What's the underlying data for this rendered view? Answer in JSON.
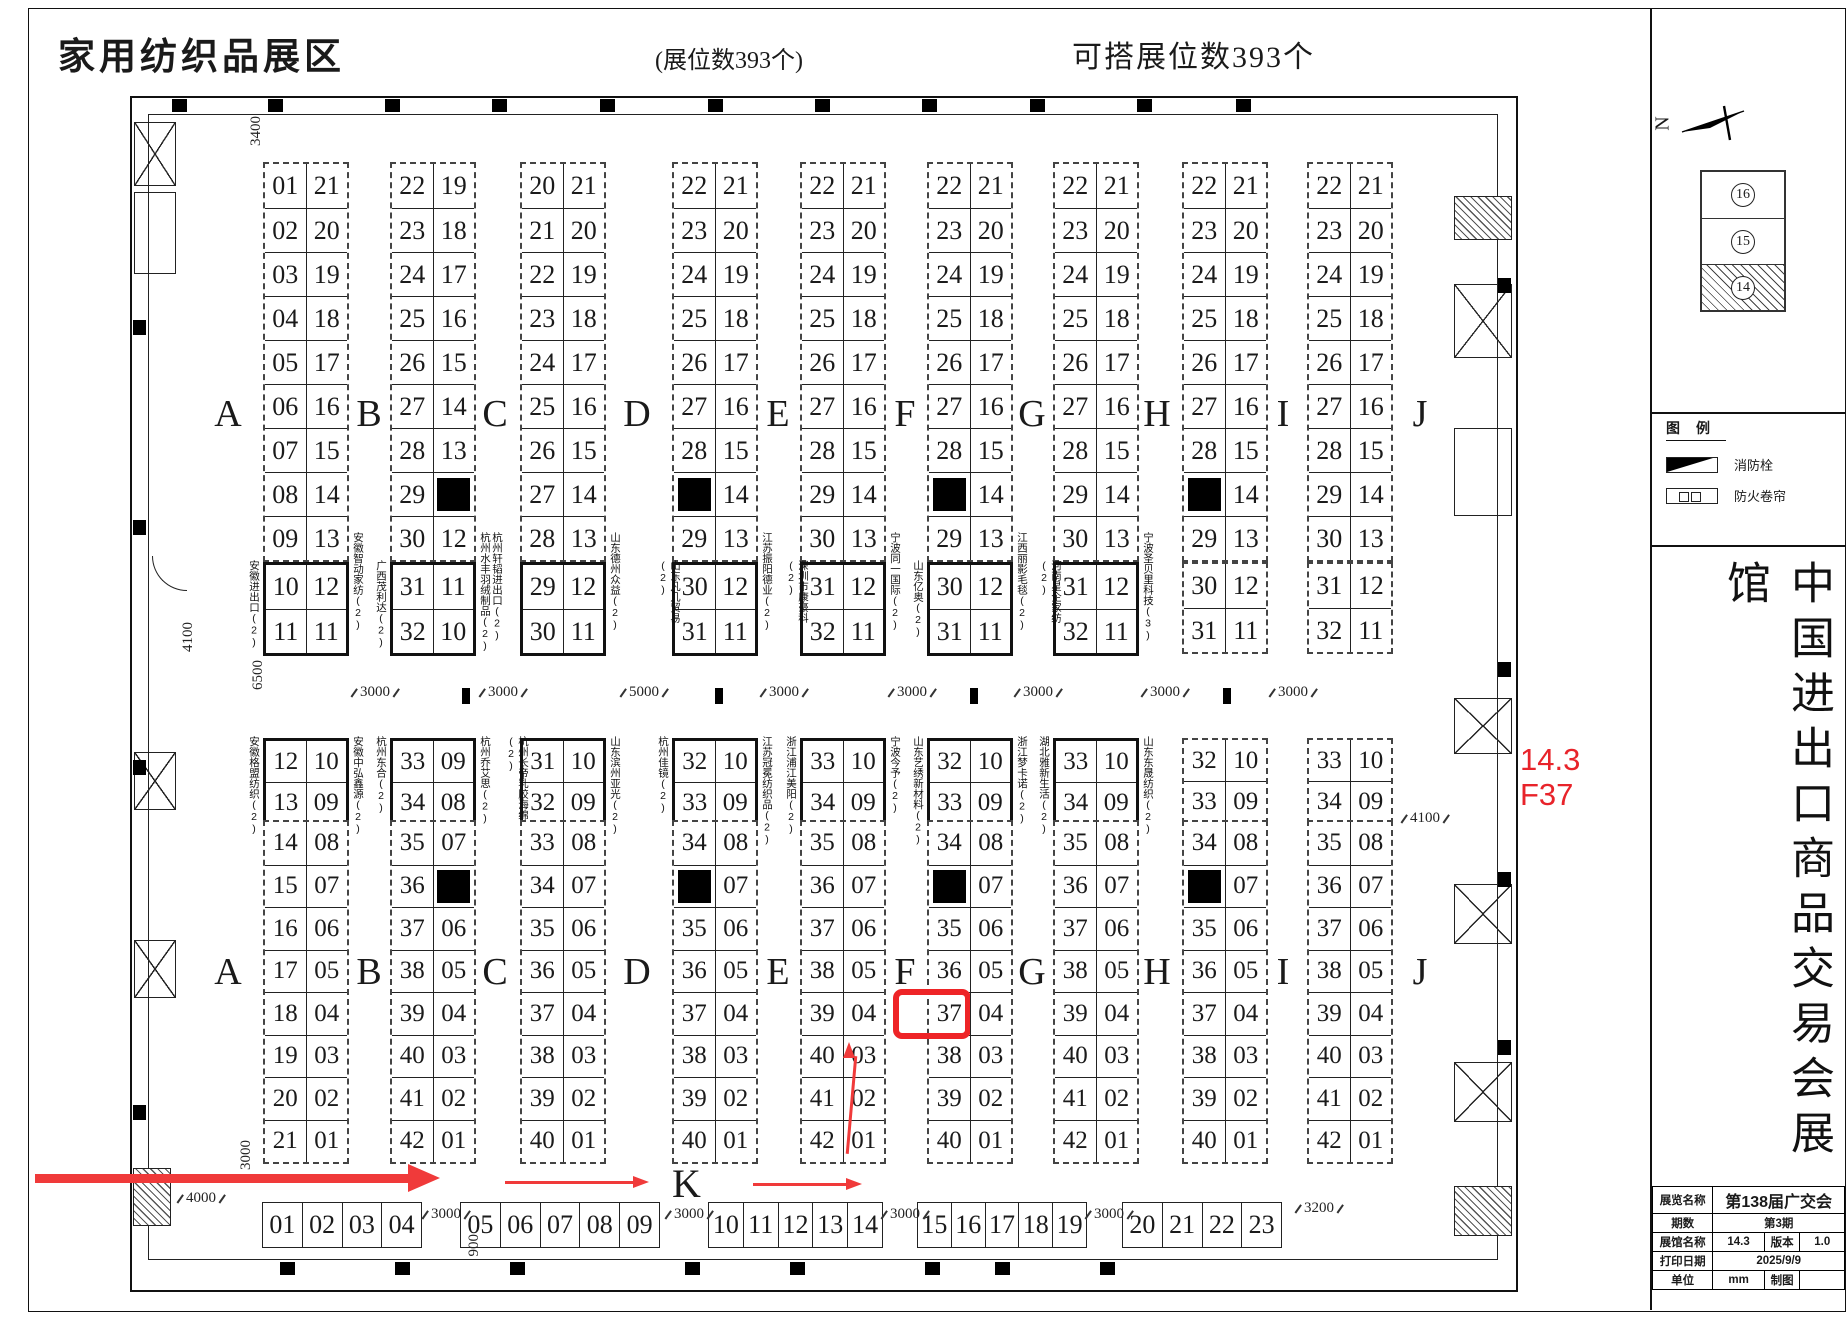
{
  "header": {
    "title": "家用纺织品展区",
    "booth_count_note": "(展位数393个)",
    "buildable_note": "可搭展位数393个"
  },
  "floor": {
    "letters": [
      "A",
      "B",
      "C",
      "D",
      "E",
      "F",
      "G",
      "H",
      "I",
      "J"
    ],
    "letter_x": [
      228,
      369,
      495,
      637,
      778,
      905,
      1032,
      1157,
      1283,
      1420
    ],
    "block_x": [
      263,
      390,
      520,
      672,
      800,
      927,
      1053,
      1182,
      1307
    ],
    "top_blocks": [
      {
        "main": [
          [
            "01",
            "21"
          ],
          [
            "02",
            "20"
          ],
          [
            "03",
            "19"
          ],
          [
            "04",
            "18"
          ],
          [
            "05",
            "17"
          ],
          [
            "06",
            "16"
          ],
          [
            "07",
            "15"
          ],
          [
            "08",
            "14"
          ],
          [
            "09",
            "13"
          ]
        ],
        "box": [
          [
            "10",
            "12"
          ],
          [
            "11",
            "11"
          ]
        ],
        "box_solid": true,
        "label_left": "安徽进出口(2)",
        "label_right": "安徽智动家纺(2)"
      },
      {
        "main": [
          [
            "22",
            "19"
          ],
          [
            "23",
            "18"
          ],
          [
            "24",
            "17"
          ],
          [
            "25",
            "16"
          ],
          [
            "26",
            "15"
          ],
          [
            "27",
            "14"
          ],
          [
            "28",
            "13"
          ],
          [
            "29",
            "■"
          ],
          [
            "30",
            "12"
          ]
        ],
        "box": [
          [
            "31",
            "11"
          ],
          [
            "32",
            "10"
          ]
        ],
        "box_solid": true,
        "label_left": "广西茂利达(2)",
        "label_right": "杭州轩韬进出口(2) 杭州水丰羽绒制品(2)"
      },
      {
        "main": [
          [
            "20",
            "21"
          ],
          [
            "21",
            "20"
          ],
          [
            "22",
            "19"
          ],
          [
            "23",
            "18"
          ],
          [
            "24",
            "17"
          ],
          [
            "25",
            "16"
          ],
          [
            "26",
            "15"
          ],
          [
            "27",
            "14"
          ],
          [
            "28",
            "13"
          ]
        ],
        "box": [
          [
            "29",
            "12"
          ],
          [
            "30",
            "11"
          ]
        ],
        "box_solid": true,
        "label_left": "",
        "label_right": "山东德州众益(2)"
      },
      {
        "main": [
          [
            "22",
            "21"
          ],
          [
            "23",
            "20"
          ],
          [
            "24",
            "19"
          ],
          [
            "25",
            "18"
          ],
          [
            "26",
            "17"
          ],
          [
            "27",
            "16"
          ],
          [
            "28",
            "15"
          ],
          [
            "■",
            "14"
          ],
          [
            "29",
            "13"
          ]
        ],
        "box": [
          [
            "30",
            "12"
          ],
          [
            "31",
            "11"
          ]
        ],
        "box_solid": true,
        "label_left": "山东凡几贸易(2)",
        "label_right": "江苏振阳德业(2)"
      },
      {
        "main": [
          [
            "22",
            "21"
          ],
          [
            "23",
            "20"
          ],
          [
            "24",
            "19"
          ],
          [
            "25",
            "18"
          ],
          [
            "26",
            "17"
          ],
          [
            "27",
            "16"
          ],
          [
            "28",
            "15"
          ],
          [
            "29",
            "14"
          ],
          [
            "30",
            "13"
          ]
        ],
        "box": [
          [
            "31",
            "12"
          ],
          [
            "32",
            "11"
          ]
        ],
        "box_solid": true,
        "label_left": "深圳市康豪科(2)",
        "label_right": "宁波同一国际(2)"
      },
      {
        "main": [
          [
            "22",
            "21"
          ],
          [
            "23",
            "20"
          ],
          [
            "24",
            "19"
          ],
          [
            "25",
            "18"
          ],
          [
            "26",
            "17"
          ],
          [
            "27",
            "16"
          ],
          [
            "28",
            "15"
          ],
          [
            "■",
            "14"
          ],
          [
            "29",
            "13"
          ]
        ],
        "box": [
          [
            "30",
            "12"
          ],
          [
            "31",
            "11"
          ]
        ],
        "box_solid": true,
        "label_left": "山东亿奥(2)",
        "label_right": "江西丽影毛毯(2)"
      },
      {
        "main": [
          [
            "22",
            "21"
          ],
          [
            "23",
            "20"
          ],
          [
            "24",
            "19"
          ],
          [
            "25",
            "18"
          ],
          [
            "26",
            "17"
          ],
          [
            "27",
            "16"
          ],
          [
            "28",
            "15"
          ],
          [
            "29",
            "14"
          ],
          [
            "30",
            "13"
          ]
        ],
        "box": [
          [
            "31",
            "12"
          ],
          [
            "32",
            "11"
          ]
        ],
        "box_solid": true,
        "label_left": "河南星企家纺(2)",
        "label_right": "宁波圣贝里科技(3)"
      },
      {
        "main": [
          [
            "22",
            "21"
          ],
          [
            "23",
            "20"
          ],
          [
            "24",
            "19"
          ],
          [
            "25",
            "18"
          ],
          [
            "26",
            "17"
          ],
          [
            "27",
            "16"
          ],
          [
            "28",
            "15"
          ],
          [
            "■",
            "14"
          ],
          [
            "29",
            "13"
          ]
        ],
        "box": [
          [
            "30",
            "12"
          ],
          [
            "31",
            "11"
          ]
        ],
        "box_solid": false,
        "label_left": "",
        "label_right": ""
      },
      {
        "main": [
          [
            "22",
            "21"
          ],
          [
            "23",
            "20"
          ],
          [
            "24",
            "19"
          ],
          [
            "25",
            "18"
          ],
          [
            "26",
            "17"
          ],
          [
            "27",
            "16"
          ],
          [
            "28",
            "15"
          ],
          [
            "29",
            "14"
          ],
          [
            "30",
            "13"
          ]
        ],
        "box": [
          [
            "31",
            "12"
          ],
          [
            "32",
            "11"
          ]
        ],
        "box_solid": false,
        "label_left": "",
        "label_right": ""
      }
    ],
    "bottom_blocks": [
      {
        "box": [
          [
            "12",
            "10"
          ],
          [
            "13",
            "09"
          ]
        ],
        "box_solid": true,
        "label_left": "安徽格盟纺织(2)",
        "label_right": "安徽中弘鑫源(2)",
        "main": [
          [
            "14",
            "08"
          ],
          [
            "15",
            "07"
          ],
          [
            "16",
            "06"
          ],
          [
            "17",
            "05"
          ],
          [
            "18",
            "04"
          ],
          [
            "19",
            "03"
          ],
          [
            "20",
            "02"
          ],
          [
            "21",
            "01"
          ]
        ]
      },
      {
        "box": [
          [
            "33",
            "09"
          ],
          [
            "34",
            "08"
          ]
        ],
        "box_solid": true,
        "label_left": "杭州东合(2)",
        "label_right": "杭州乔艾思(2)",
        "main": [
          [
            "35",
            "07"
          ],
          [
            "36",
            "■"
          ],
          [
            "37",
            "06"
          ],
          [
            "38",
            "05"
          ],
          [
            "39",
            "04"
          ],
          [
            "40",
            "03"
          ],
          [
            "41",
            "02"
          ],
          [
            "42",
            "01"
          ]
        ]
      },
      {
        "box": [
          [
            "31",
            "10"
          ],
          [
            "32",
            "09"
          ]
        ],
        "box_solid": true,
        "label_left": "杭州长帝乳胶海绵(2)",
        "label_right": "山东滨州亚光(2)",
        "main": [
          [
            "33",
            "08"
          ],
          [
            "34",
            "07"
          ],
          [
            "35",
            "06"
          ],
          [
            "36",
            "05"
          ],
          [
            "37",
            "04"
          ],
          [
            "38",
            "03"
          ],
          [
            "39",
            "02"
          ],
          [
            "40",
            "01"
          ]
        ]
      },
      {
        "box": [
          [
            "32",
            "10"
          ],
          [
            "33",
            "09"
          ]
        ],
        "box_solid": true,
        "label_left": "杭州佳镜(2)",
        "label_right": "江苏冠冕纺织品(2)",
        "main": [
          [
            "34",
            "08"
          ],
          [
            "■",
            "07"
          ],
          [
            "35",
            "06"
          ],
          [
            "36",
            "05"
          ],
          [
            "37",
            "04"
          ],
          [
            "38",
            "03"
          ],
          [
            "39",
            "02"
          ],
          [
            "40",
            "01"
          ]
        ]
      },
      {
        "box": [
          [
            "33",
            "10"
          ],
          [
            "34",
            "09"
          ]
        ],
        "box_solid": true,
        "label_left": "浙江浦江美阳(2)",
        "label_right": "宁波今予(2)",
        "main": [
          [
            "35",
            "08"
          ],
          [
            "36",
            "07"
          ],
          [
            "37",
            "06"
          ],
          [
            "38",
            "05"
          ],
          [
            "39",
            "04"
          ],
          [
            "40",
            "03"
          ],
          [
            "41",
            "02"
          ],
          [
            "42",
            "01"
          ]
        ]
      },
      {
        "box": [
          [
            "32",
            "10"
          ],
          [
            "33",
            "09"
          ]
        ],
        "box_solid": true,
        "label_left": "山东艺绣新材料(2)",
        "label_right": "浙江梦卡诺(2)",
        "main": [
          [
            "34",
            "08"
          ],
          [
            "■",
            "07"
          ],
          [
            "35",
            "06"
          ],
          [
            "36",
            "05"
          ],
          [
            "37",
            "04"
          ],
          [
            "38",
            "03"
          ],
          [
            "39",
            "02"
          ],
          [
            "40",
            "01"
          ]
        ],
        "highlight": "37"
      },
      {
        "box": [
          [
            "33",
            "10"
          ],
          [
            "34",
            "09"
          ]
        ],
        "box_solid": true,
        "label_left": "湖北雅新生活(2)",
        "label_right": "山东东晟纺织(2)",
        "main": [
          [
            "35",
            "08"
          ],
          [
            "36",
            "07"
          ],
          [
            "37",
            "06"
          ],
          [
            "38",
            "05"
          ],
          [
            "39",
            "04"
          ],
          [
            "40",
            "03"
          ],
          [
            "41",
            "02"
          ],
          [
            "42",
            "01"
          ]
        ]
      },
      {
        "box": [
          [
            "32",
            "10"
          ],
          [
            "33",
            "09"
          ]
        ],
        "box_solid": false,
        "label_left": "",
        "label_right": "",
        "main": [
          [
            "34",
            "08"
          ],
          [
            "■",
            "07"
          ],
          [
            "35",
            "06"
          ],
          [
            "36",
            "05"
          ],
          [
            "37",
            "04"
          ],
          [
            "38",
            "03"
          ],
          [
            "39",
            "02"
          ],
          [
            "40",
            "01"
          ]
        ]
      },
      {
        "box": [
          [
            "33",
            "10"
          ],
          [
            "34",
            "09"
          ]
        ],
        "box_solid": false,
        "label_left": "",
        "label_right": "",
        "main": [
          [
            "35",
            "08"
          ],
          [
            "36",
            "07"
          ],
          [
            "37",
            "06"
          ],
          [
            "38",
            "05"
          ],
          [
            "39",
            "04"
          ],
          [
            "40",
            "03"
          ],
          [
            "41",
            "02"
          ],
          [
            "42",
            "01"
          ]
        ]
      }
    ],
    "k_row": {
      "letter": "K",
      "groups": [
        {
          "x": 262,
          "w": 40,
          "values": [
            "01",
            "02",
            "03",
            "04"
          ]
        },
        {
          "x": 460,
          "w": 40,
          "values": [
            "05",
            "06",
            "07",
            "08",
            "09"
          ]
        },
        {
          "x": 708,
          "w": 35,
          "values": [
            "10",
            "11",
            "12",
            "13",
            "14"
          ]
        },
        {
          "x": 917,
          "w": 34,
          "values": [
            "15",
            "16",
            "17",
            "18",
            "19"
          ]
        },
        {
          "x": 1122,
          "w": 40,
          "values": [
            "20",
            "21",
            "22",
            "23"
          ]
        }
      ]
    }
  },
  "dimensions": {
    "mid_aisle": [
      {
        "t": "3000",
        "x": 348
      },
      {
        "t": "3000",
        "x": 476
      },
      {
        "t": "5000",
        "x": 617
      },
      {
        "t": "3000",
        "x": 757
      },
      {
        "t": "3000",
        "x": 885
      },
      {
        "t": "3000",
        "x": 1011
      },
      {
        "t": "3000",
        "x": 1138
      },
      {
        "t": "3000",
        "x": 1266
      }
    ],
    "k_aisle": [
      {
        "t": "3000",
        "x": 419
      },
      {
        "t": "3000",
        "x": 662
      },
      {
        "t": "3000",
        "x": 878
      },
      {
        "t": "3000",
        "x": 1082
      }
    ],
    "vertical": [
      {
        "t": "3400",
        "x": 248,
        "y": 116
      },
      {
        "t": "6500",
        "x": 250,
        "y": 660
      },
      {
        "t": "4100",
        "x": 180,
        "y": 622
      },
      {
        "t": "3000",
        "x": 238,
        "y": 1140
      },
      {
        "t": "900",
        "x": 466,
        "y": 1234
      }
    ],
    "horizontal": [
      {
        "t": "4100",
        "x": 1398,
        "y": 810
      },
      {
        "t": "4000",
        "x": 174,
        "y": 1190
      },
      {
        "t": "3200",
        "x": 1292,
        "y": 1200
      }
    ]
  },
  "annotations": {
    "color": "#e8232a",
    "line1": "14.3",
    "line2": "F37",
    "highlighted_booth": "F37"
  },
  "side_panel": {
    "compass_label": "N",
    "overview": {
      "halls": [
        "16",
        "15",
        "14"
      ],
      "current": "14"
    },
    "legend": {
      "title": "图例",
      "items": [
        {
          "icon": "fire-hydrant-icon",
          "label": "消防栓"
        },
        {
          "icon": "fire-shutter-icon",
          "label": "防火卷帘"
        }
      ]
    },
    "hall_title": "中国进出口商品交易会展馆",
    "info_table": {
      "rows": [
        [
          "展览名称",
          "第138届广交会"
        ],
        [
          "期数",
          "第3期"
        ],
        [
          "展馆名称",
          "14.3",
          "版本",
          "1.0"
        ],
        [
          "打印日期",
          "2025/9/9"
        ],
        [
          "单位",
          "mm",
          "制图",
          ""
        ]
      ]
    }
  }
}
